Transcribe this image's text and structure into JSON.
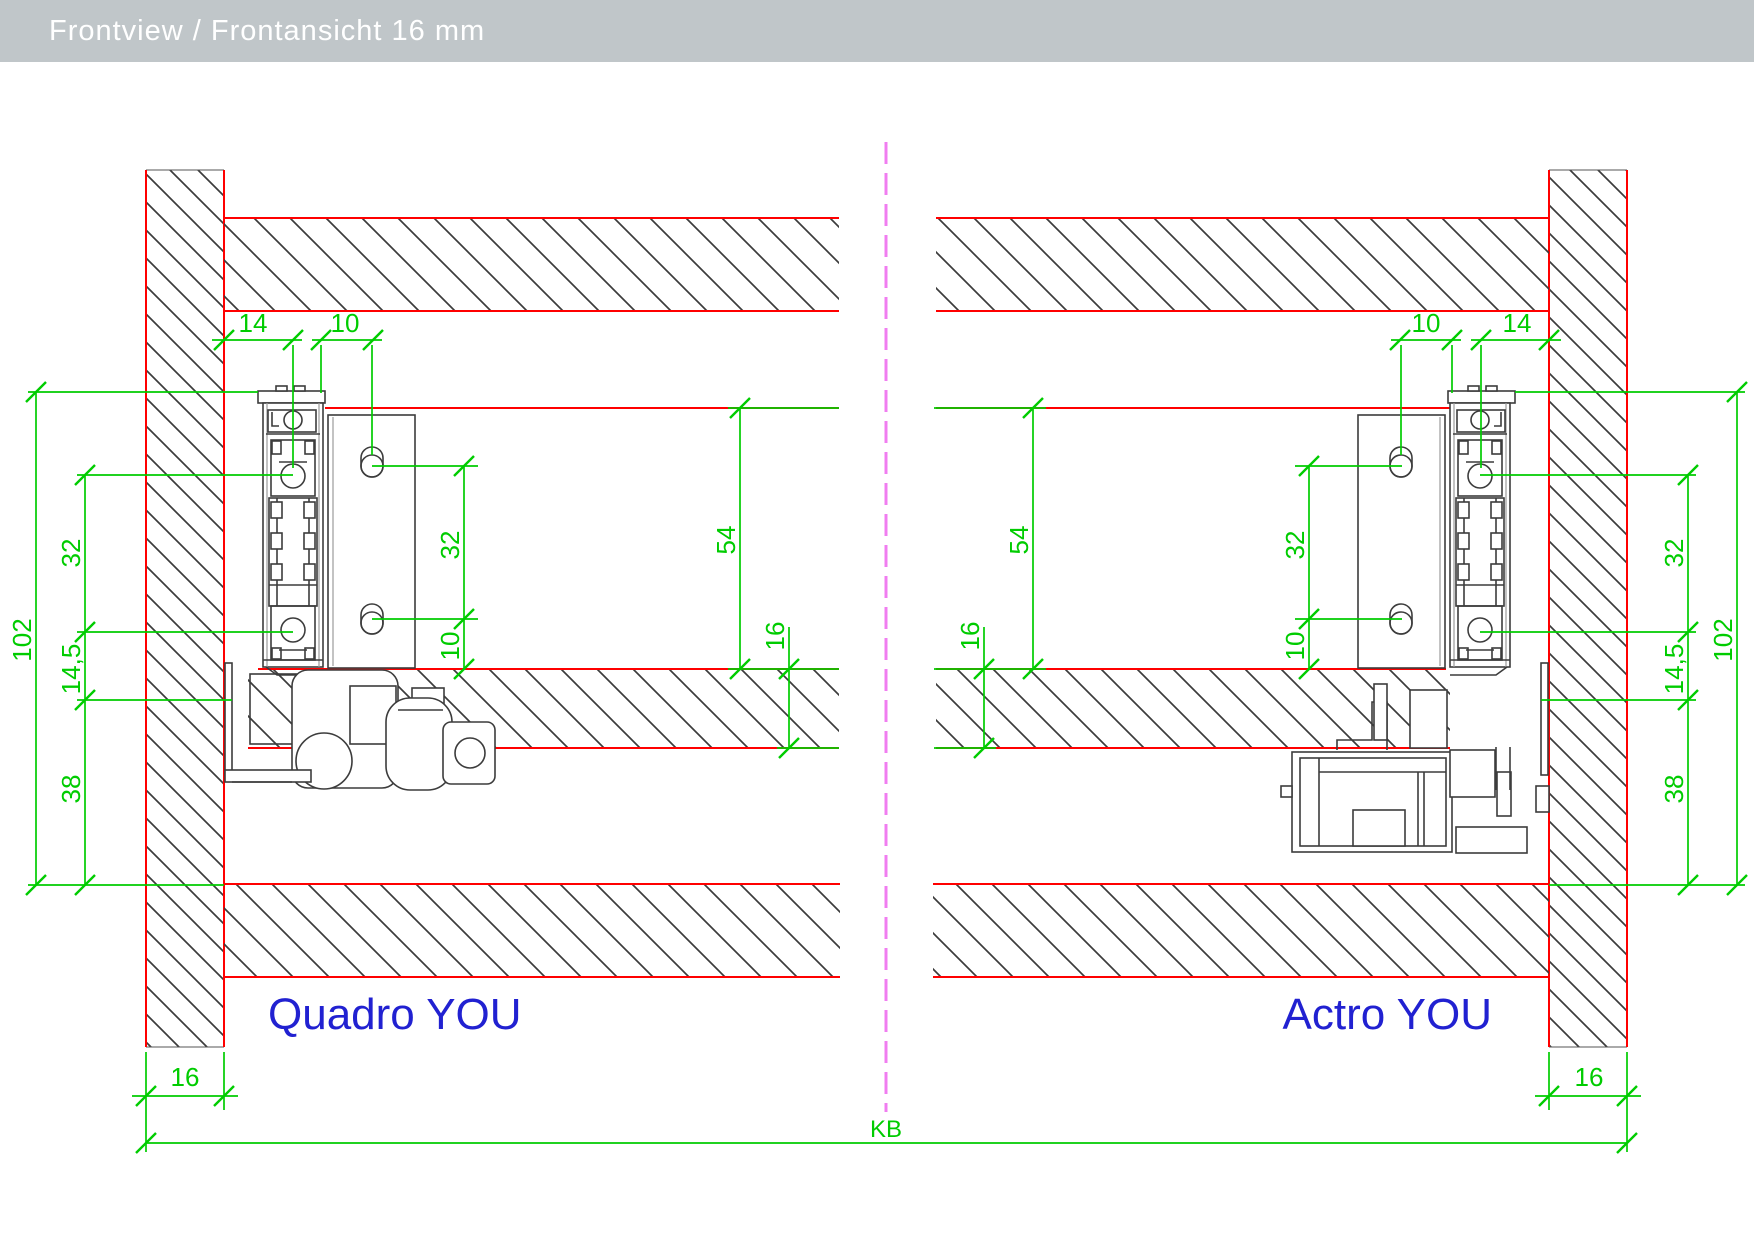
{
  "header": {
    "title": "Frontview / Frontansicht 16 mm"
  },
  "left_view": {
    "label": "Quadro YOU",
    "dims": {
      "back_offset": "14",
      "front_offset": "10",
      "total_height": "102",
      "screw_spacing": "32",
      "mid_offset": "14,5",
      "bottom_offset": "38",
      "front_hole_spacing": "32",
      "hole_to_shelf": "10",
      "front_top_to_shelf": "54",
      "shelf_thickness": "16",
      "panel_thickness": "16"
    }
  },
  "right_view": {
    "label": "Actro YOU",
    "dims": {
      "back_offset": "14",
      "front_offset": "10",
      "total_height": "102",
      "screw_spacing": "32",
      "mid_offset": "14,5",
      "bottom_offset": "38",
      "front_hole_spacing": "32",
      "hole_to_shelf": "10",
      "front_top_to_shelf": "54",
      "shelf_thickness": "16",
      "panel_thickness": "16"
    }
  },
  "footer": {
    "cabinet_width_label": "KB"
  },
  "colors": {
    "dim_green": "#00cc00",
    "line_red": "#ff0000",
    "centerline_pink": "#f07df0",
    "label_blue": "#2121d1",
    "header_bg": "#c0c6c9",
    "header_text": "#ffffff",
    "hardware_dark": "#3c3c3c"
  }
}
